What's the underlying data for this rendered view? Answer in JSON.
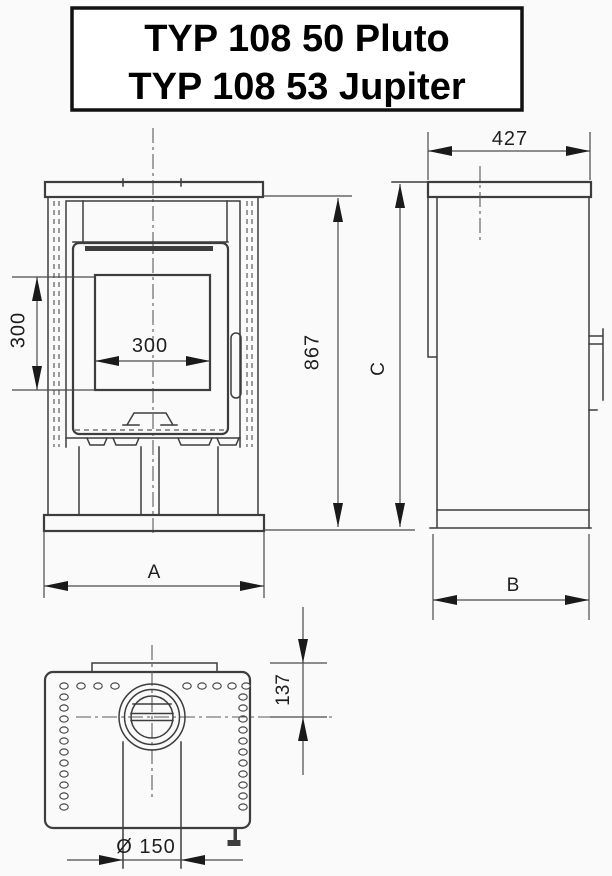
{
  "title": {
    "line1": "TYP 108 50 Pluto",
    "line2": "TYP 108 53 Jupiter"
  },
  "dimensions": {
    "window_height": "300",
    "window_width": "300",
    "front_total_height": "867",
    "front_width_label": "A",
    "side_depth": "427",
    "side_height_label": "C",
    "side_depth_label": "B",
    "flue_center_offset": "137",
    "flue_diameter": "Ø 150"
  },
  "colors": {
    "background": "#fafafa",
    "line": "#3d3d3d",
    "dim_line": "#4a4a4a",
    "arrow": "#1a1a1a",
    "text": "#1f1f1f",
    "title_border": "#111111"
  }
}
